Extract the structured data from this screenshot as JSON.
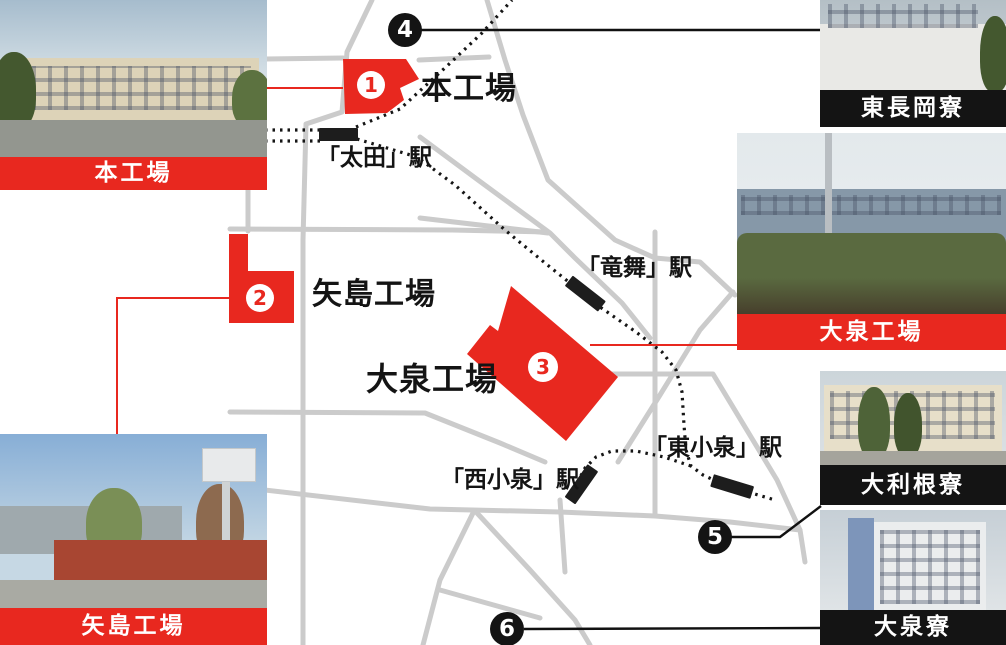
{
  "colors": {
    "accent_red": "#e8281f",
    "road_gray": "#cbcbcb",
    "rail_black": "#151515"
  },
  "map": {
    "plants": {
      "honkojo": {
        "marker": "1",
        "label": "本工場"
      },
      "yajima": {
        "marker": "2",
        "label": "矢島工場"
      },
      "oizumi": {
        "marker": "3",
        "label": "大泉工場"
      }
    },
    "stations": {
      "ota": {
        "label": "「太田」駅"
      },
      "ryumai": {
        "label": "「竜舞」駅"
      },
      "nishikoizumi": {
        "label": "「西小泉」駅"
      },
      "higashikoizumi": {
        "label": "「東小泉」駅"
      }
    },
    "dorm_markers": {
      "m4": "4",
      "m5": "5",
      "m6": "6"
    }
  },
  "photos": {
    "honkojo": {
      "caption": "本工場"
    },
    "higashinagaoka": {
      "caption": "東長岡寮"
    },
    "oizumi_plant": {
      "caption": "大泉工場"
    },
    "otone": {
      "caption": "大利根寮"
    },
    "oizumi_dorm": {
      "caption": "大泉寮"
    },
    "yajima": {
      "caption": "矢島工場"
    }
  }
}
